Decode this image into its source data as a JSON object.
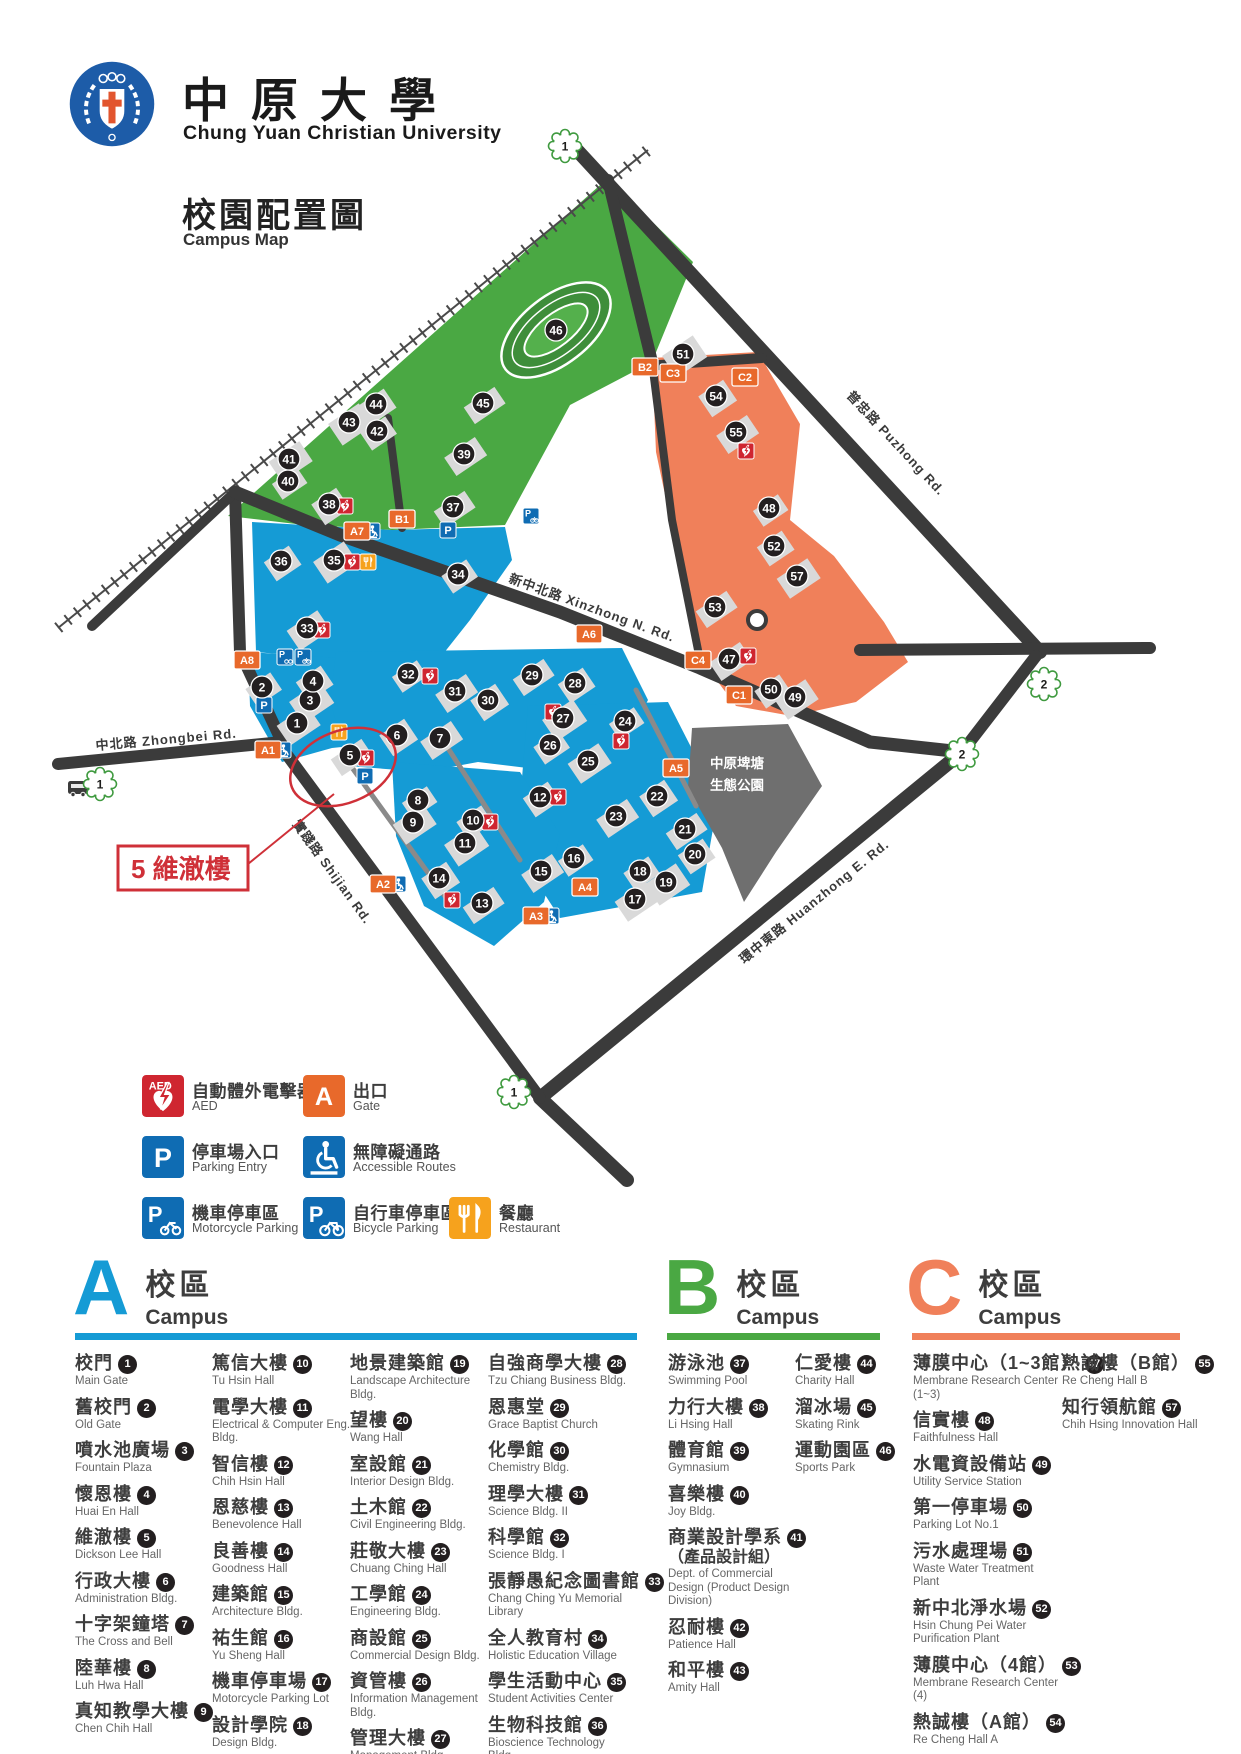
{
  "header": {
    "university_zh": "中原大學",
    "university_en": "Chung Yuan Christian University",
    "map_title_zh": "校園配置圖",
    "map_title_en": "Campus Map"
  },
  "callout": {
    "text": "5 維澈樓"
  },
  "legend": {
    "items": [
      {
        "icon": "aed-icon",
        "zh": "自動體外電擊器",
        "en": "AED"
      },
      {
        "icon": "gate-icon",
        "zh": "出口",
        "en": "Gate",
        "letter": "A"
      },
      {
        "icon": "parking-entry-icon",
        "zh": "停車場入口",
        "en": "Parking Entry"
      },
      {
        "icon": "accessible-icon",
        "zh": "無障礙通路",
        "en": "Accessible Routes"
      },
      {
        "icon": "motorcycle-parking-icon",
        "zh": "機車停車區",
        "en": "Motorcycle Parking"
      },
      {
        "icon": "bicycle-parking-icon",
        "zh": "自行車停車區",
        "en": "Bicycle Parking"
      },
      {
        "icon": "restaurant-icon",
        "zh": "餐廳",
        "en": "Restaurant"
      }
    ]
  },
  "map": {
    "colors": {
      "campus_a": "#159bd5",
      "campus_b": "#4aa843",
      "campus_c": "#f0805a",
      "road": "#3b3b3b",
      "building": "#d9d9d9",
      "park": "#6f6f6f",
      "accent_red": "#cf3038"
    },
    "road_labels": [
      {
        "text": "新中北路  Xinzhong N. Rd.",
        "x": 508,
        "y": 582,
        "rot": 20
      },
      {
        "text": "普忠路  Puzhong Rd.",
        "x": 846,
        "y": 396,
        "rot": 47
      },
      {
        "text": "中北路  Zhongbei Rd.",
        "x": 96,
        "y": 750,
        "rot": -5
      },
      {
        "text": "實踐路  Shijian Rd.",
        "x": 292,
        "y": 824,
        "rot": 54
      },
      {
        "text": "環中東路  Huanzhong E. Rd.",
        "x": 744,
        "y": 964,
        "rot": -39
      }
    ],
    "park_label": [
      "中原埤塘",
      "生態公園"
    ],
    "markers": [
      {
        "n": 1,
        "x": 297,
        "y": 723
      },
      {
        "n": 2,
        "x": 262,
        "y": 687
      },
      {
        "n": 3,
        "x": 310,
        "y": 700
      },
      {
        "n": 4,
        "x": 313,
        "y": 681
      },
      {
        "n": 5,
        "x": 350,
        "y": 755
      },
      {
        "n": 6,
        "x": 397,
        "y": 735
      },
      {
        "n": 7,
        "x": 440,
        "y": 738
      },
      {
        "n": 8,
        "x": 418,
        "y": 800
      },
      {
        "n": 9,
        "x": 413,
        "y": 822
      },
      {
        "n": 10,
        "x": 473,
        "y": 820
      },
      {
        "n": 11,
        "x": 465,
        "y": 843
      },
      {
        "n": 12,
        "x": 540,
        "y": 797
      },
      {
        "n": 13,
        "x": 482,
        "y": 903
      },
      {
        "n": 14,
        "x": 439,
        "y": 878
      },
      {
        "n": 15,
        "x": 541,
        "y": 871
      },
      {
        "n": 16,
        "x": 574,
        "y": 858
      },
      {
        "n": 17,
        "x": 635,
        "y": 899
      },
      {
        "n": 18,
        "x": 640,
        "y": 871
      },
      {
        "n": 19,
        "x": 666,
        "y": 882
      },
      {
        "n": 20,
        "x": 695,
        "y": 854
      },
      {
        "n": 21,
        "x": 685,
        "y": 829
      },
      {
        "n": 22,
        "x": 657,
        "y": 796
      },
      {
        "n": 23,
        "x": 616,
        "y": 816
      },
      {
        "n": 24,
        "x": 625,
        "y": 721
      },
      {
        "n": 25,
        "x": 588,
        "y": 761
      },
      {
        "n": 26,
        "x": 550,
        "y": 745
      },
      {
        "n": 27,
        "x": 563,
        "y": 718
      },
      {
        "n": 28,
        "x": 575,
        "y": 683
      },
      {
        "n": 29,
        "x": 532,
        "y": 675
      },
      {
        "n": 30,
        "x": 488,
        "y": 700
      },
      {
        "n": 31,
        "x": 455,
        "y": 691
      },
      {
        "n": 32,
        "x": 408,
        "y": 674
      },
      {
        "n": 33,
        "x": 307,
        "y": 628
      },
      {
        "n": 34,
        "x": 458,
        "y": 574
      },
      {
        "n": 35,
        "x": 334,
        "y": 560
      },
      {
        "n": 36,
        "x": 281,
        "y": 561
      },
      {
        "n": 37,
        "x": 453,
        "y": 507
      },
      {
        "n": 38,
        "x": 329,
        "y": 504
      },
      {
        "n": 39,
        "x": 464,
        "y": 454
      },
      {
        "n": 40,
        "x": 288,
        "y": 481
      },
      {
        "n": 41,
        "x": 289,
        "y": 459
      },
      {
        "n": 42,
        "x": 377,
        "y": 431
      },
      {
        "n": 43,
        "x": 349,
        "y": 422
      },
      {
        "n": 44,
        "x": 376,
        "y": 404
      },
      {
        "n": 45,
        "x": 483,
        "y": 403
      },
      {
        "n": 46,
        "x": 556,
        "y": 330
      },
      {
        "n": 47,
        "x": 729,
        "y": 659
      },
      {
        "n": 48,
        "x": 769,
        "y": 508
      },
      {
        "n": 49,
        "x": 795,
        "y": 697
      },
      {
        "n": 50,
        "x": 771,
        "y": 689
      },
      {
        "n": 51,
        "x": 683,
        "y": 354
      },
      {
        "n": 52,
        "x": 774,
        "y": 546
      },
      {
        "n": 53,
        "x": 715,
        "y": 607
      },
      {
        "n": 54,
        "x": 716,
        "y": 396
      },
      {
        "n": 55,
        "x": 736,
        "y": 432
      },
      {
        "n": 57,
        "x": 797,
        "y": 576
      }
    ],
    "gates": [
      {
        "id": "A1",
        "x": 268,
        "y": 750
      },
      {
        "id": "A2",
        "x": 383,
        "y": 884
      },
      {
        "id": "A3",
        "x": 536,
        "y": 916
      },
      {
        "id": "A4",
        "x": 585,
        "y": 887
      },
      {
        "id": "A5",
        "x": 676,
        "y": 768
      },
      {
        "id": "A6",
        "x": 589,
        "y": 634
      },
      {
        "id": "A7",
        "x": 357,
        "y": 531
      },
      {
        "id": "A8",
        "x": 247,
        "y": 660
      },
      {
        "id": "B1",
        "x": 402,
        "y": 519
      },
      {
        "id": "B2",
        "x": 645,
        "y": 367
      },
      {
        "id": "C1",
        "x": 739,
        "y": 695
      },
      {
        "id": "C2",
        "x": 745,
        "y": 377
      },
      {
        "id": "C3",
        "x": 673,
        "y": 373
      },
      {
        "id": "C4",
        "x": 698,
        "y": 660
      }
    ],
    "icons": [
      {
        "t": "aed",
        "x": 345,
        "y": 506
      },
      {
        "t": "aed",
        "x": 352,
        "y": 562
      },
      {
        "t": "aed",
        "x": 322,
        "y": 630
      },
      {
        "t": "aed",
        "x": 430,
        "y": 676
      },
      {
        "t": "aed",
        "x": 553,
        "y": 712
      },
      {
        "t": "aed",
        "x": 621,
        "y": 741
      },
      {
        "t": "aed",
        "x": 366,
        "y": 758
      },
      {
        "t": "aed",
        "x": 558,
        "y": 797
      },
      {
        "t": "aed",
        "x": 452,
        "y": 900
      },
      {
        "t": "aed",
        "x": 490,
        "y": 822
      },
      {
        "t": "aed",
        "x": 748,
        "y": 656
      },
      {
        "t": "aed",
        "x": 746,
        "y": 451
      },
      {
        "t": "p",
        "x": 448,
        "y": 530
      },
      {
        "t": "p",
        "x": 365,
        "y": 776
      },
      {
        "t": "p",
        "x": 264,
        "y": 705
      },
      {
        "t": "pm",
        "x": 285,
        "y": 657
      },
      {
        "t": "pb",
        "x": 303,
        "y": 657
      },
      {
        "t": "pb",
        "x": 531,
        "y": 516
      },
      {
        "t": "acc",
        "x": 372,
        "y": 531
      },
      {
        "t": "acc",
        "x": 283,
        "y": 750
      },
      {
        "t": "acc",
        "x": 398,
        "y": 884
      },
      {
        "t": "acc",
        "x": 551,
        "y": 916
      },
      {
        "t": "rest",
        "x": 368,
        "y": 562
      },
      {
        "t": "rest",
        "x": 339,
        "y": 732
      },
      {
        "t": "bus",
        "x": 78,
        "y": 788
      }
    ],
    "clouds": [
      {
        "n": "1",
        "x": 565,
        "y": 146
      },
      {
        "n": "2",
        "x": 1044,
        "y": 684
      },
      {
        "n": "2",
        "x": 962,
        "y": 754
      },
      {
        "n": "1",
        "x": 514,
        "y": 1092
      },
      {
        "n": "1",
        "x": 100,
        "y": 784
      }
    ]
  },
  "campuses": [
    {
      "letter": "A",
      "color": "#159bd5",
      "title_zh": "校區",
      "title_en": "Campus",
      "columns": [
        [
          {
            "num": "1",
            "zh": "校門",
            "en": "Main Gate"
          },
          {
            "num": "2",
            "zh": "舊校門",
            "en": "Old Gate"
          },
          {
            "num": "3",
            "zh": "噴水池廣場",
            "en": "Fountain Plaza"
          },
          {
            "num": "4",
            "zh": "懷恩樓",
            "en": "Huai En Hall"
          },
          {
            "num": "5",
            "zh": "維澈樓",
            "en": "Dickson Lee Hall"
          },
          {
            "num": "6",
            "zh": "行政大樓",
            "en": "Administration Bldg."
          },
          {
            "num": "7",
            "zh": "十字架鐘塔",
            "en": "The Cross and Bell"
          },
          {
            "num": "8",
            "zh": "陸華樓",
            "en": "Luh Hwa Hall"
          },
          {
            "num": "9",
            "zh": "真知教學大樓",
            "en": "Chen Chih Hall"
          }
        ],
        [
          {
            "num": "10",
            "zh": "篤信大樓",
            "en": "Tu Hsin Hall"
          },
          {
            "num": "11",
            "zh": "電學大樓",
            "en": "Electrical & Computer Eng. Bldg."
          },
          {
            "num": "12",
            "zh": "智信樓",
            "en": "Chih Hsin Hall"
          },
          {
            "num": "13",
            "zh": "恩慈樓",
            "en": "Benevolence Hall"
          },
          {
            "num": "14",
            "zh": "良善樓",
            "en": "Goodness Hall"
          },
          {
            "num": "15",
            "zh": "建築館",
            "en": "Architecture Bldg."
          },
          {
            "num": "16",
            "zh": "祐生館",
            "en": "Yu Sheng Hall"
          },
          {
            "num": "17",
            "zh": "機車停車場",
            "en": "Motorcycle Parking Lot"
          },
          {
            "num": "18",
            "zh": "設計學院",
            "en": "Design Bldg."
          }
        ],
        [
          {
            "num": "19",
            "zh": "地景建築館",
            "en": "Landscape Architecture Bldg."
          },
          {
            "num": "20",
            "zh": "望樓",
            "en": "Wang Hall"
          },
          {
            "num": "21",
            "zh": "室設館",
            "en": "Interior Design Bldg."
          },
          {
            "num": "22",
            "zh": "土木館",
            "en": "Civil Engineering Bldg."
          },
          {
            "num": "23",
            "zh": "莊敬大樓",
            "en": "Chuang Ching Hall"
          },
          {
            "num": "24",
            "zh": "工學館",
            "en": "Engineering Bldg."
          },
          {
            "num": "25",
            "zh": "商設館",
            "en": "Commercial Design Bldg."
          },
          {
            "num": "26",
            "zh": "資管樓",
            "en": "Information Management Bldg."
          },
          {
            "num": "27",
            "zh": "管理大樓",
            "en": "Management Bldg."
          }
        ],
        [
          {
            "num": "28",
            "zh": "自強商學大樓",
            "en": "Tzu Chiang Business Bldg."
          },
          {
            "num": "29",
            "zh": "恩惠堂",
            "en": "Grace Baptist Church"
          },
          {
            "num": "30",
            "zh": "化學館",
            "en": "Chemistry Bldg."
          },
          {
            "num": "31",
            "zh": "理學大樓",
            "en": "Science Bldg. II"
          },
          {
            "num": "32",
            "zh": "科學館",
            "en": "Science Bldg. I"
          },
          {
            "num": "33",
            "zh": "張靜愚紀念圖書館",
            "en": "Chang Ching Yu Memorial Library"
          },
          {
            "num": "34",
            "zh": "全人教育村",
            "en": "Holistic Education Village"
          },
          {
            "num": "35",
            "zh": "學生活動中心",
            "en": "Student Activities Center"
          },
          {
            "num": "36",
            "zh": "生物科技館",
            "en": "Bioscience Technology Bldg."
          }
        ]
      ]
    },
    {
      "letter": "B",
      "color": "#4aa843",
      "title_zh": "校區",
      "title_en": "Campus",
      "columns": [
        [
          {
            "num": "37",
            "zh": "游泳池",
            "en": "Swimming Pool"
          },
          {
            "num": "38",
            "zh": "力行大樓",
            "en": "Li Hsing Hall"
          },
          {
            "num": "39",
            "zh": "體育館",
            "en": "Gymnasium"
          },
          {
            "num": "40",
            "zh": "喜樂樓",
            "en": "Joy Bldg."
          },
          {
            "num": "41",
            "zh": "商業設計學系",
            "zh_sub": "（產品設計組）",
            "en": "Dept. of Commercial Design (Product Design Division)"
          },
          {
            "num": "42",
            "zh": "忍耐樓",
            "en": "Patience Hall"
          },
          {
            "num": "43",
            "zh": "和平樓",
            "en": "Amity Hall"
          }
        ],
        [
          {
            "num": "44",
            "zh": "仁愛樓",
            "en": "Charity Hall"
          },
          {
            "num": "45",
            "zh": "溜冰場",
            "en": "Skating Rink"
          },
          {
            "num": "46",
            "zh": "運動園區",
            "en": "Sports Park"
          }
        ]
      ]
    },
    {
      "letter": "C",
      "color": "#f0805a",
      "title_zh": "校區",
      "title_en": "Campus",
      "columns": [
        [
          {
            "num": "47",
            "zh": "薄膜中心（1~3館）",
            "en": "Membrane Research Center (1~3)"
          },
          {
            "num": "48",
            "zh": "信實樓",
            "en": "Faithfulness Hall"
          },
          {
            "num": "49",
            "zh": "水電資設備站",
            "en": "Utility Service Station"
          },
          {
            "num": "50",
            "zh": "第一停車場",
            "en": "Parking Lot No.1"
          },
          {
            "num": "51",
            "zh": "污水處理場",
            "en": "Waste Water Treatment Plant"
          },
          {
            "num": "52",
            "zh": "新中北淨水場",
            "en": "Hsin Chung Pei Water Purification Plant"
          },
          {
            "num": "53",
            "zh": "薄膜中心（4館）",
            "en": "Membrane Research Center (4)"
          },
          {
            "num": "54",
            "zh": "熱誠樓（A館）",
            "en": "Re Cheng Hall A"
          }
        ],
        [
          {
            "num": "55",
            "zh": "熱誠樓（B館）",
            "en": "Re Cheng Hall B"
          },
          {
            "num": "57",
            "zh": "知行領航館",
            "en": "Chih Hsing Innovation Hall"
          }
        ]
      ]
    }
  ]
}
